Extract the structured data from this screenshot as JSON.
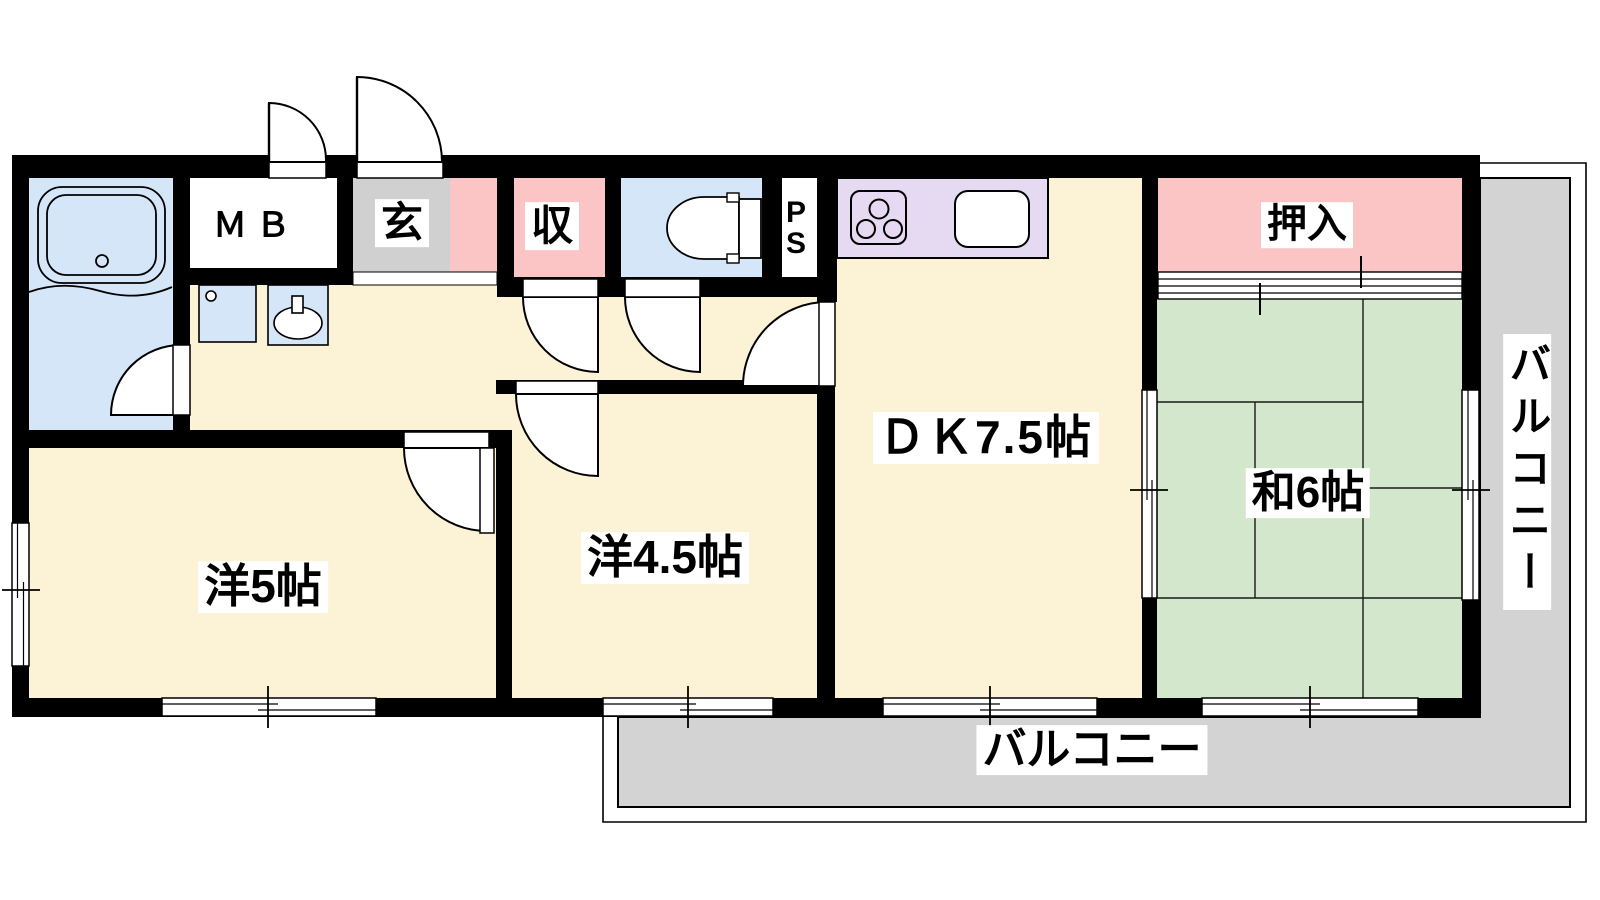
{
  "floorplan": {
    "rooms": {
      "western_5": {
        "label": "洋5帖"
      },
      "western_4_5": {
        "label": "洋4.5帖"
      },
      "dining_kitchen": {
        "label": "ＤＫ7.5帖"
      },
      "japanese_6": {
        "label": "和6帖"
      },
      "oshiire_closet": {
        "label": "押入"
      },
      "storage": {
        "label": "収"
      },
      "entrance": {
        "label": "玄"
      },
      "meter_box": {
        "label": "ＭＢ"
      },
      "pipe_space": {
        "p": "P",
        "s": "S"
      },
      "balcony_bottom": {
        "label": "バルコニー"
      },
      "balcony_right": {
        "label": "バルコニー"
      }
    },
    "colors": {
      "wall": "#000000",
      "wood_floor": "#FCF2D5",
      "water_area": "#D5E6F8",
      "closet_pink": "#FBC5C6",
      "tatami_green": "#D3E7CC",
      "balcony_gray": "#D3D3D3",
      "entrance_gray": "#D0D0D0",
      "kitchen_counter": "#E5DAF2"
    }
  }
}
